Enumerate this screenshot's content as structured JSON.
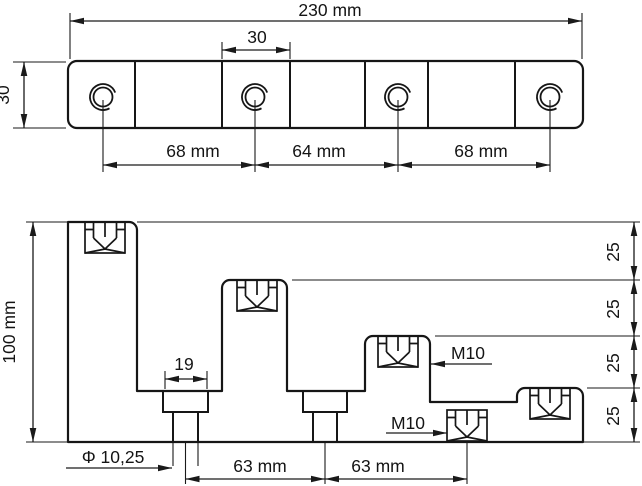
{
  "drawing": {
    "background": "#ffffff",
    "line_color": "#161616",
    "top_view": {
      "title": "bar-top-view",
      "overall_width": "230 mm",
      "cell_width": "30",
      "bar_height": "30",
      "hole_pitches": [
        "68 mm",
        "64 mm",
        "68 mm"
      ]
    },
    "front_view": {
      "title": "stepped-section-view",
      "overall_height": "100 mm",
      "counterbore_width": "19",
      "hole_diameter": "Φ 10,25",
      "hole_pitches": [
        "63 mm",
        "63 mm"
      ],
      "step_heights": [
        "25",
        "25",
        "25",
        "25"
      ],
      "thread_callouts": [
        "M10",
        "M10"
      ]
    }
  }
}
